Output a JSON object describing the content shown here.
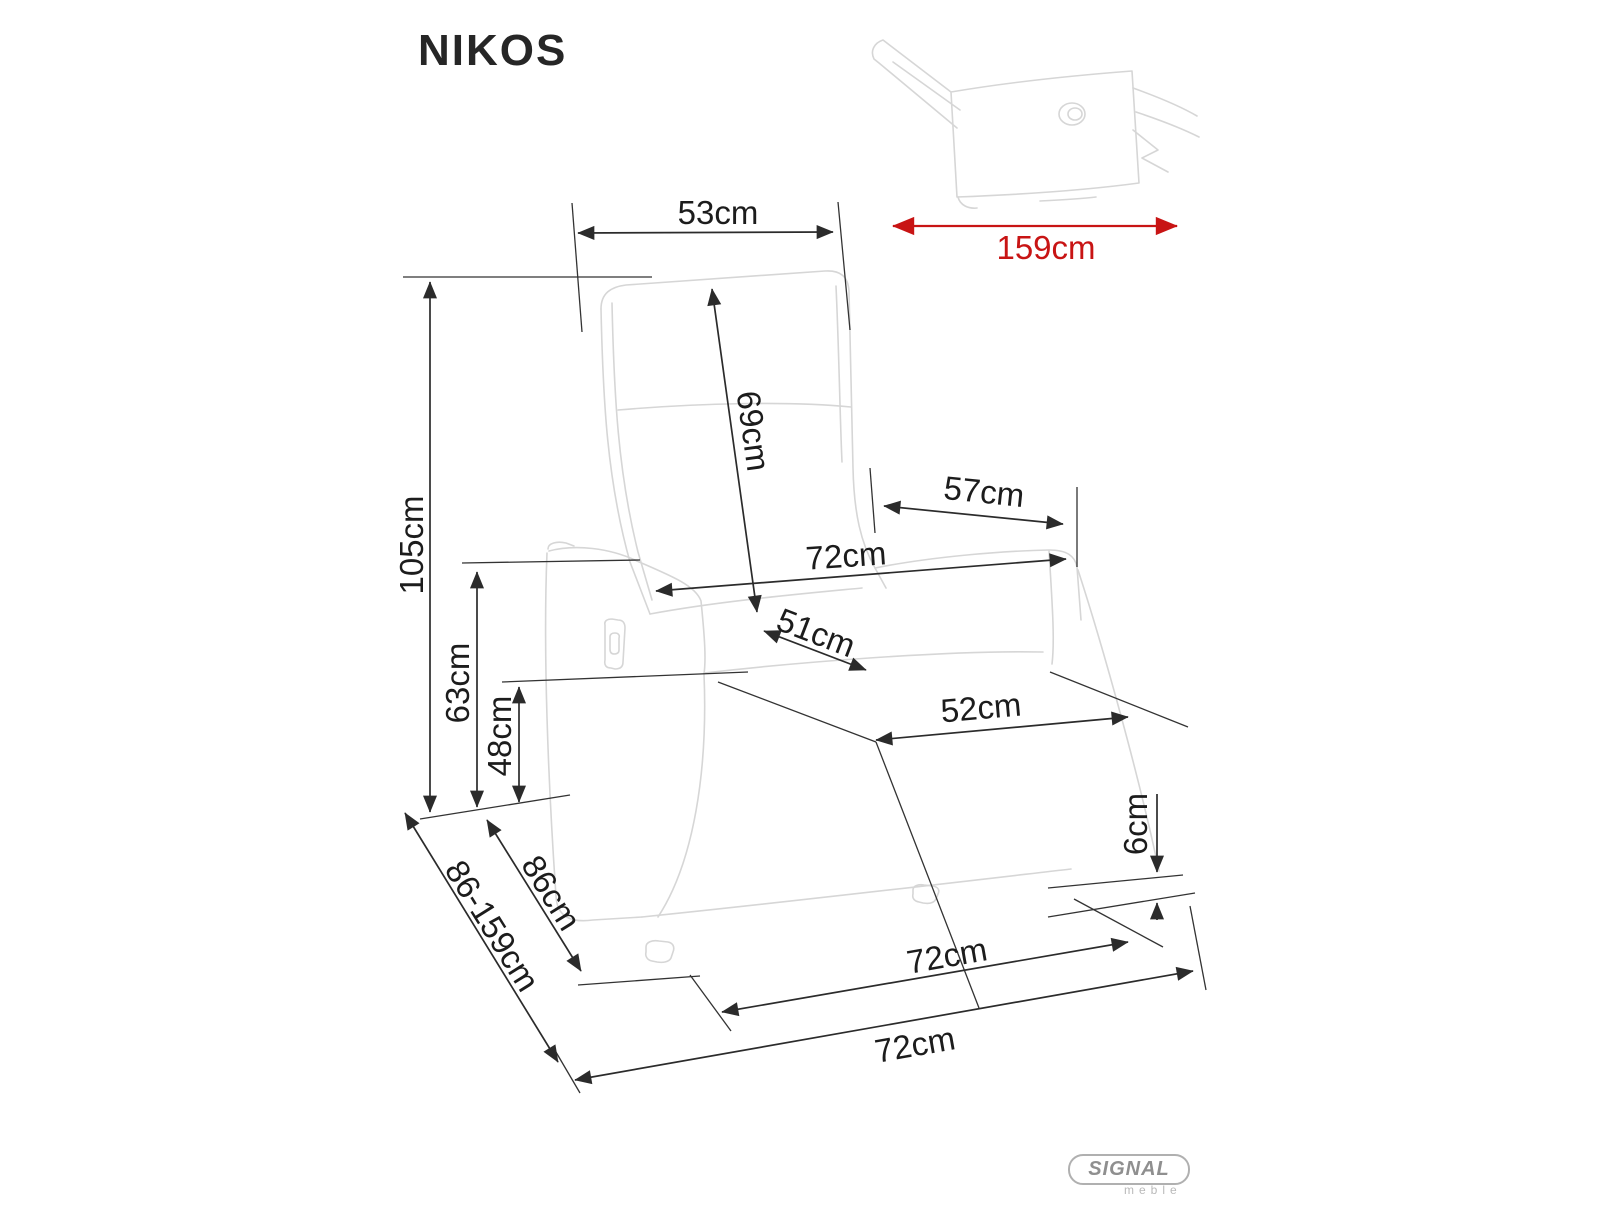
{
  "page": {
    "title": "NIKOS"
  },
  "dimensions": {
    "backrest_width": "53cm",
    "backrest_height": "69cm",
    "back_to_armrest_front": "57cm",
    "overall_width": "72cm",
    "seat_depth": "51cm",
    "seat_width": "52cm",
    "overall_height": "105cm",
    "armrest_height": "63cm",
    "seat_height": "48cm",
    "depth_upright": "86cm",
    "depth_range": "86-159cm",
    "base_clearance": "6cm",
    "base_width": "72cm",
    "front_width": "72cm",
    "reclined_length": "159cm"
  },
  "logo": {
    "brand": "SIGNAL",
    "subtitle": "meble"
  },
  "colors": {
    "dimension_line": "#2b2b2b",
    "label_text": "#1c1c1c",
    "sketch_outline": "#d6d6d6",
    "accent_red": "#c81414",
    "logo_gray": "#8f8f8f"
  }
}
